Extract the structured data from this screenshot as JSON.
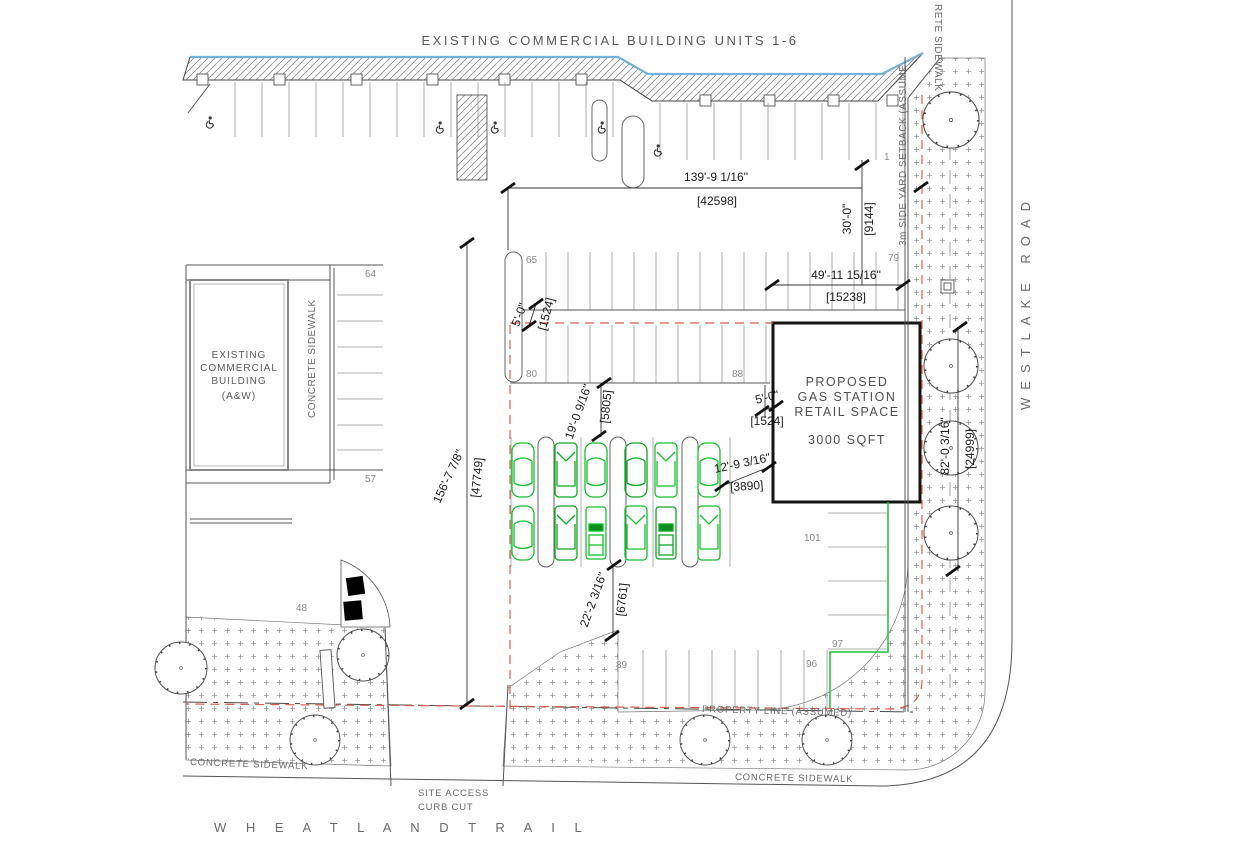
{
  "drawing_title": "Gas station site plan",
  "buildings": {
    "units_label": "EXISTING  COMMERCIAL  BUILDING  UNITS  1-6",
    "aw": {
      "l1": "EXISTING",
      "l2": "COMMERCIAL",
      "l3": "BUILDING",
      "l4": "(A&W)"
    },
    "proposed": {
      "l1": "PROPOSED",
      "l2": "GAS  STATION",
      "l3": "RETAIL  SPACE",
      "area": "3000  SQFT"
    }
  },
  "roads": {
    "east": "WESTLAKE ROAD",
    "south": "W H E A T L A N D   T R A I L"
  },
  "labels": {
    "sidewalk_left_vertical": "CONCRETE  SIDEWALK",
    "sidewalk_bottom_left": "CONCRETE  SIDEWALK",
    "sidewalk_bottom_right": "CONCRETE  SIDEWALK",
    "sidewalk_right_clipped": "RETE  SIDEWALK",
    "side_yard_setback": "3m  SIDE  YARD  SETBACK  (ASSUME",
    "property_line": "PROPERTY  LINE  (ASSUMED)",
    "site_access_1": "SITE  ACCESS",
    "site_access_2": "CURB  CUT"
  },
  "dims": {
    "d139": {
      "ft": "139'-9 1/16\"",
      "mm": "[42598]"
    },
    "d30": {
      "ft": "30'-0\"",
      "mm": "[9144]"
    },
    "d49": {
      "ft": "49'-11 15/16\"",
      "mm": "[15238]"
    },
    "d156": {
      "ft": "156'-7 7/8\"",
      "mm": "[47749]"
    },
    "d19": {
      "ft": "19'-0 9/16\"",
      "mm": "[5805]"
    },
    "d12": {
      "ft": "12'-9 3/16\"",
      "mm": "[3890]"
    },
    "d22": {
      "ft": "22'-2 3/16\"",
      "mm": "[6761]"
    },
    "d82": {
      "ft": "82'-0 3/16\"",
      "mm": "[24999]"
    },
    "d5a": {
      "ft": "5'-0\"",
      "mm": "[1524]"
    },
    "d5b": {
      "ft": "5'-0\"",
      "mm": "[1524]"
    }
  },
  "nums": {
    "n1": "1",
    "n48": "48",
    "n57": "57",
    "n64": "64",
    "n65": "65",
    "n79": "79",
    "n80": "80",
    "n88": "88",
    "n89": "89",
    "n96": "96",
    "n97": "97",
    "n101": "101"
  },
  "colors": {
    "line": "#555555",
    "water_blue": "#74b2dc",
    "property_red": "#d4604f",
    "curb_green": "#1fbf3f",
    "car_green": "#15c02c"
  },
  "icons": {
    "handicap": "wheelchair symbol",
    "tree": "circle tree symbol",
    "catch_basin": "square drain"
  }
}
